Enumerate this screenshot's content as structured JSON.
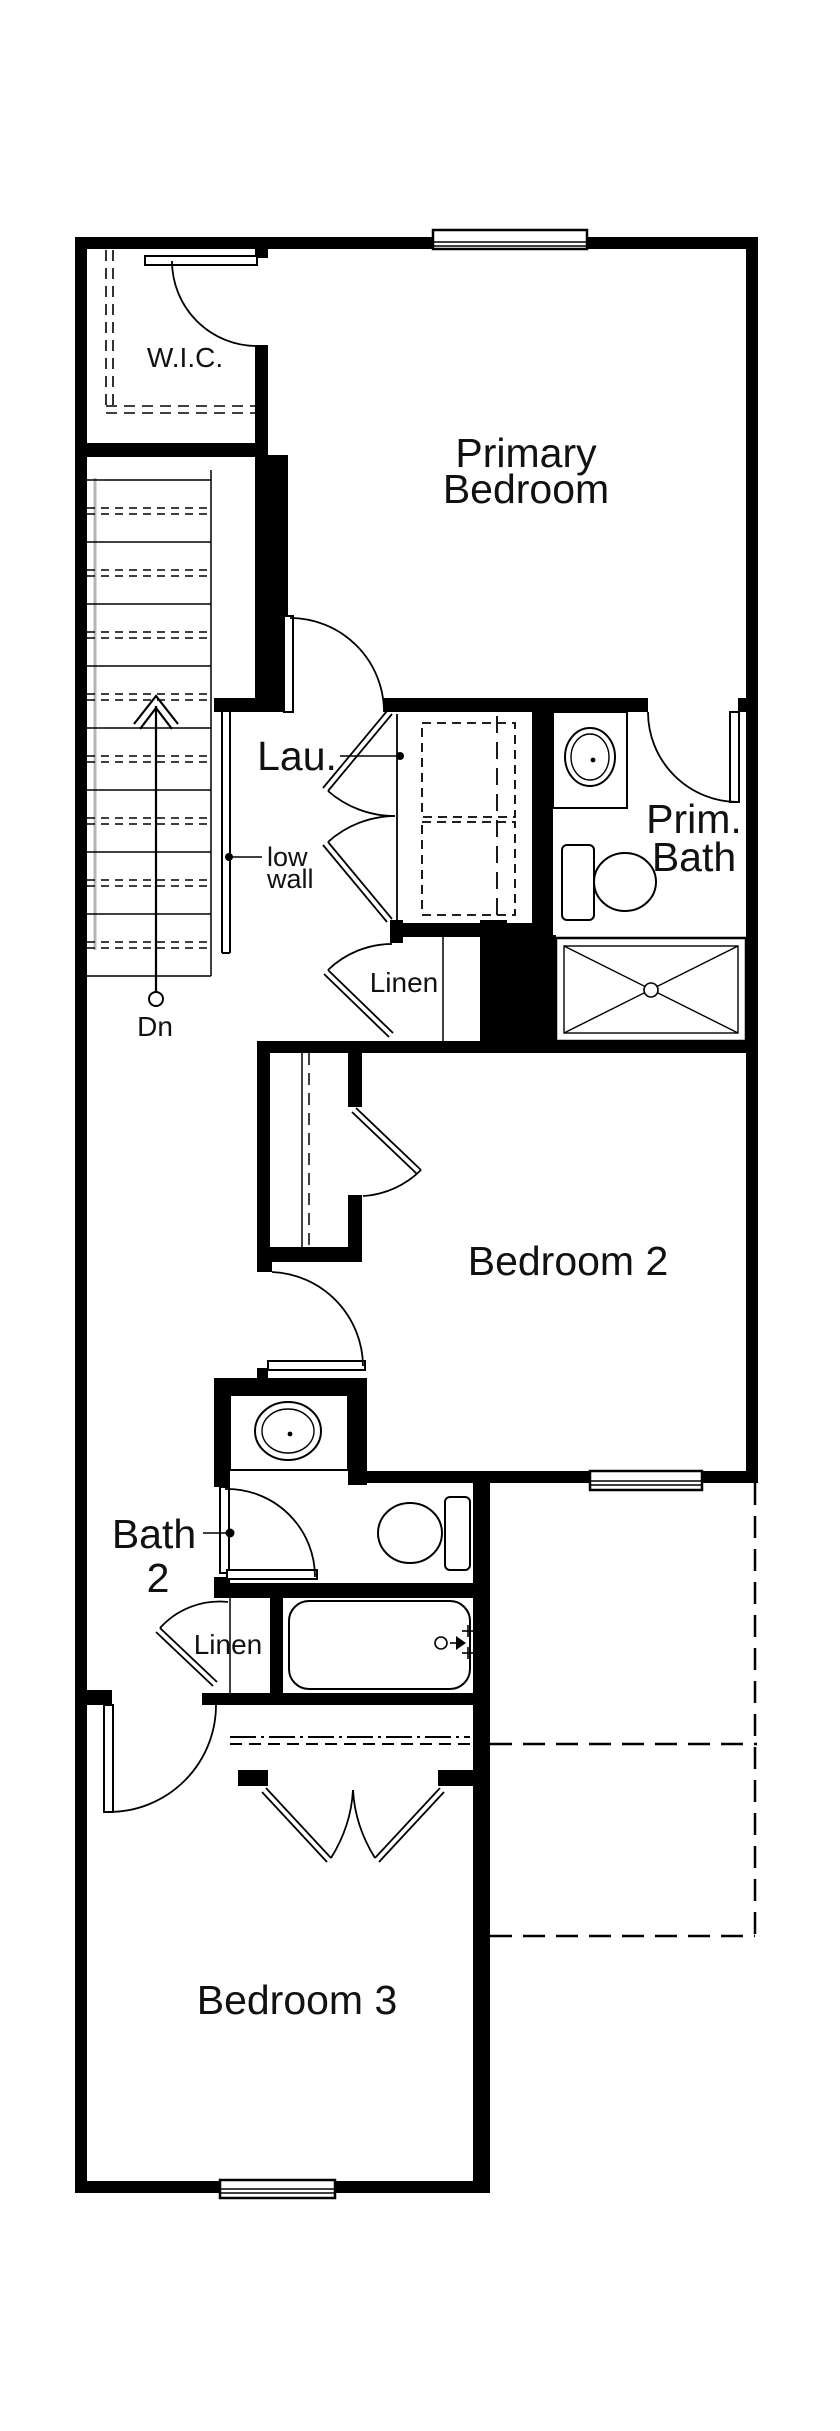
{
  "plan": {
    "title": "Upper floor plan",
    "colors": {
      "wall": "#000000",
      "line": "#000000",
      "background": "#ffffff",
      "text": "#111111"
    },
    "rooms": {
      "wic": "W.I.C.",
      "primary_bedroom_line1": "Primary",
      "primary_bedroom_line2": "Bedroom",
      "laundry": "Lau.",
      "primary_bath_line1": "Prim.",
      "primary_bath_line2": "Bath",
      "linen_upper": "Linen",
      "bedroom2": "Bedroom 2",
      "bath2_line1": "Bath",
      "bath2_line2": "2",
      "linen_lower": "Linen",
      "bedroom3": "Bedroom 3"
    },
    "annotations": {
      "stairs_down": "Dn",
      "low_wall_line1": "low",
      "low_wall_line2": "wall"
    }
  }
}
